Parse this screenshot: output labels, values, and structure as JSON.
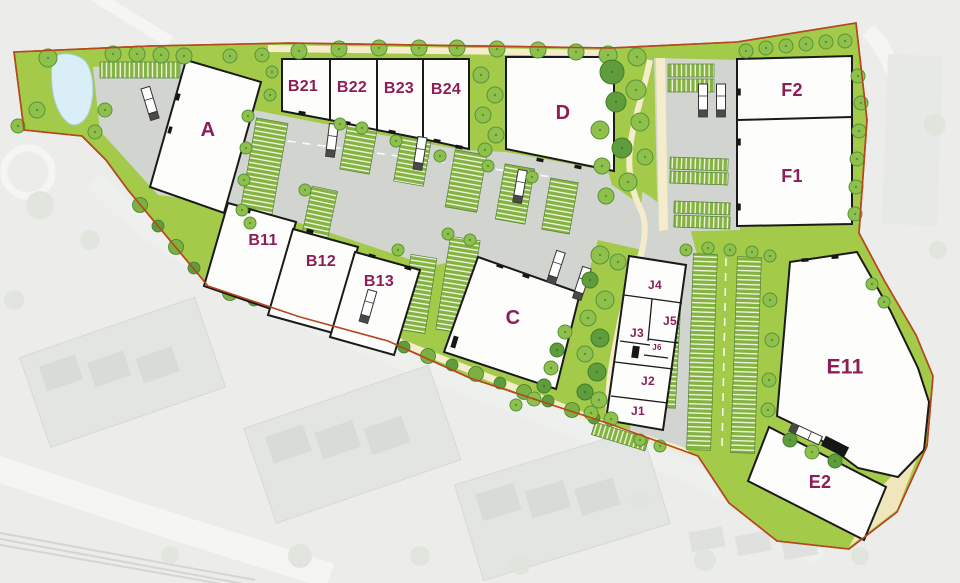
{
  "buildings": {
    "a": {
      "label": "A"
    },
    "b21": {
      "label": "B21"
    },
    "b22": {
      "label": "B22"
    },
    "b23": {
      "label": "B23"
    },
    "b24": {
      "label": "B24"
    },
    "b11": {
      "label": "B11"
    },
    "b12": {
      "label": "B12"
    },
    "b13": {
      "label": "B13"
    },
    "c": {
      "label": "C"
    },
    "d": {
      "label": "D"
    },
    "f2": {
      "label": "F2"
    },
    "f1": {
      "label": "F1"
    },
    "j1": {
      "label": "J1"
    },
    "j2": {
      "label": "J2"
    },
    "j3": {
      "label": "J3"
    },
    "j4": {
      "label": "J4"
    },
    "j5": {
      "label": "J5"
    },
    "j6": {
      "label": "J6"
    },
    "e11": {
      "label": "E11"
    },
    "e2": {
      "label": "E2"
    }
  },
  "colors": {
    "site_green": "#a4ca4a",
    "parking_stripe_dark": "#84b342",
    "parking_stripe_light": "#edf2da",
    "parking_row_outline": "#55833a",
    "tree_green": "#8fc04b",
    "tree_green_outline": "#56933a",
    "tree_dark_green": "#5f9c3c",
    "tree_dark_outline": "#417e2a",
    "road_gray": "#d2d4d0",
    "building_fill": "#fdfdfb",
    "building_outline": "#1a1a1a",
    "label_magenta": "#8c1d57",
    "boundary_red": "#b6471e",
    "path_beige": "#f4ecca",
    "sand_beige": "#f0e6bb",
    "pond_blue": "#d9eef7",
    "pond_outline": "#a8cfdf",
    "context_gray": "#ecedeb",
    "context_building": "#e3e5e3",
    "context_panel": "#d8dbd8",
    "context_road": "#f5f6f4"
  }
}
